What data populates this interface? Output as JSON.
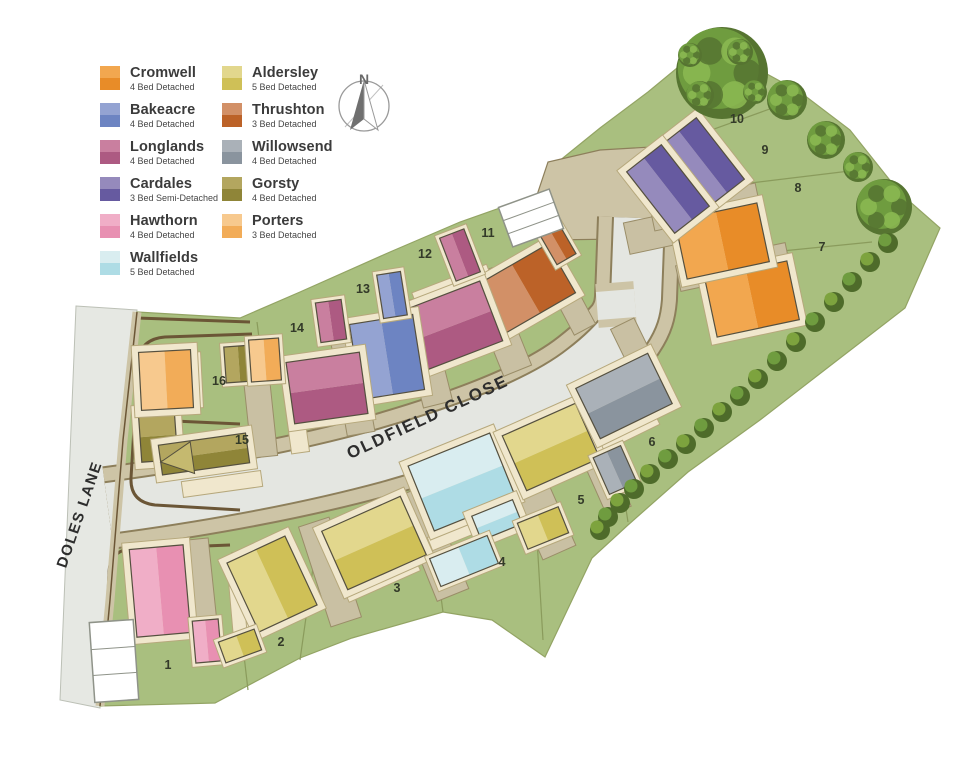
{
  "legend": {
    "columns": [
      [
        {
          "name": "Cromwell",
          "desc": "4 Bed Detached",
          "top": "#f2a74f",
          "bottom": "#e88c28"
        },
        {
          "name": "Bakeacre",
          "desc": "4 Bed Detached",
          "top": "#94a3d2",
          "bottom": "#6d84c2"
        },
        {
          "name": "Longlands",
          "desc": "4 Bed Detached",
          "top": "#c97f9f",
          "bottom": "#ad5a82"
        },
        {
          "name": "Cardales",
          "desc": "3 Bed Semi-Detached",
          "top": "#958abc",
          "bottom": "#665aa0"
        },
        {
          "name": "Hawthorn",
          "desc": "4 Bed Detached",
          "top": "#f0aec7",
          "bottom": "#e890b2"
        },
        {
          "name": "Wallfields",
          "desc": "5 Bed Detached",
          "top": "#d9edf0",
          "bottom": "#aedce5"
        }
      ],
      [
        {
          "name": "Aldersley",
          "desc": "5 Bed Detached",
          "top": "#e2d78d",
          "bottom": "#cfc057"
        },
        {
          "name": "Thrushton",
          "desc": "3 Bed Detached",
          "top": "#d29067",
          "bottom": "#bc6228"
        },
        {
          "name": "Willowsend",
          "desc": "4 Bed Detached",
          "top": "#aab1b8",
          "bottom": "#8a949e"
        },
        {
          "name": "Gorsty",
          "desc": "4 Bed Detached",
          "top": "#b3a65f",
          "bottom": "#8f8538"
        },
        {
          "name": "Porters",
          "desc": "3 Bed Detached",
          "top": "#f7c98e",
          "bottom": "#f2ac58"
        }
      ]
    ]
  },
  "compass": {
    "label": "N"
  },
  "roads": [
    {
      "name": "OLDFIELD CLOSE"
    },
    {
      "name": "DOLES LANE"
    }
  ],
  "plots": [
    {
      "number": "1",
      "type": "Hawthorn",
      "x": 168,
      "y": 669
    },
    {
      "number": "2",
      "type": "Aldersley",
      "x": 281,
      "y": 646
    },
    {
      "number": "3",
      "type": "Aldersley",
      "x": 397,
      "y": 592
    },
    {
      "number": "4",
      "type": "Wallfields",
      "x": 502,
      "y": 566
    },
    {
      "number": "5",
      "type": "Aldersley",
      "x": 581,
      "y": 504
    },
    {
      "number": "6",
      "type": "Willowsend",
      "x": 652,
      "y": 446
    },
    {
      "number": "7",
      "type": "Cromwell",
      "x": 822,
      "y": 251
    },
    {
      "number": "8",
      "type": "Cromwell",
      "x": 798,
      "y": 192
    },
    {
      "number": "9",
      "type": "Cardales",
      "x": 765,
      "y": 154
    },
    {
      "number": "10",
      "type": "Cardales",
      "x": 737,
      "y": 123
    },
    {
      "number": "11",
      "type": "Thrushton",
      "x": 488,
      "y": 237
    },
    {
      "number": "12",
      "type": "Longlands",
      "x": 425,
      "y": 258
    },
    {
      "number": "13",
      "type": "Bakeacre",
      "x": 363,
      "y": 293
    },
    {
      "number": "14",
      "type": "Longlands",
      "x": 297,
      "y": 332
    },
    {
      "number": "15",
      "type": "Gorsty",
      "x": 242,
      "y": 444
    },
    {
      "number": "16",
      "type": "Porters",
      "x": 219,
      "y": 385
    }
  ],
  "palette": {
    "site_green": "#a9bf7f",
    "site_edge": "#93a464",
    "road_grey": "#e4e6e1",
    "lane_grey": "#e6e8e3",
    "path_tan": "#cdc4a6",
    "path_edge": "#8d7f5b",
    "drive_tan": "#c9c0a3",
    "drive_edge": "#9a8d68",
    "cream": "#f0e7cd",
    "cream_edge": "#b6a87c",
    "boundary_brown": "#6b5636",
    "parcel_line": "#8a9b5c",
    "tree_dark": "#567431",
    "tree_mid": "#6f9c3f",
    "tree_light": "#8cba52",
    "hedge_dark": "#4e6b2a",
    "hedge_light": "#7da33e",
    "house_edge": "#55503f"
  }
}
